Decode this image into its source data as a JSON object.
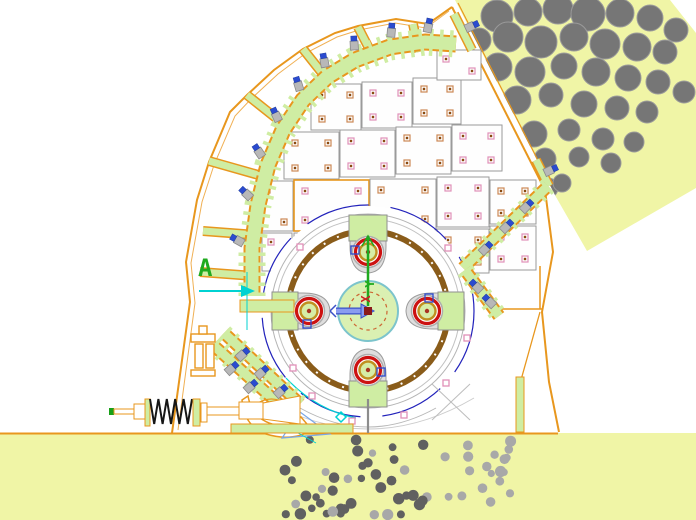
{
  "drawing": {
    "type": "cad-crusher-cross-section",
    "labels": {
      "section_marker": "A",
      "axis_y": "Y",
      "axis_x": "X"
    },
    "colors": {
      "background": "#ffffff",
      "material_fill": "#f0f5a6",
      "machine_green": "#cfeda3",
      "outline_orange": "#e8971e",
      "rock_gray": "#767676",
      "fines_dark": "#606060",
      "fines_light": "#a8a8a8",
      "ring_brown": "#8a5c1a",
      "ring_red": "#cc1111",
      "ring_gold": "#c09020",
      "arc_navy": "#2222bb",
      "accent_cyan": "#00d2d2",
      "axis_green": "#1faa1f",
      "axis_x_red": "#cc2222",
      "ucs_fill": "#8a9cf0",
      "ucs_edge": "#3a50c8",
      "plate_border": "#9a9a9a",
      "bolt_blue": "#2b4bd0",
      "marker_pink": "#e090b8",
      "spring_black": "#161616",
      "center_fill": "#daf0b2",
      "center_edge": "#7cc4cc"
    },
    "parts": {
      "feed-chute-material": "rocks entering top right chute",
      "crushed-fines": "fine material discharged at bottom",
      "rotor-assembly": "rotor with four hammer pins",
      "liner-segments": "toothed liner along housing arc",
      "tension-spring": "spring rod assembly lower left",
      "section-marker": "section view arrow A"
    }
  }
}
